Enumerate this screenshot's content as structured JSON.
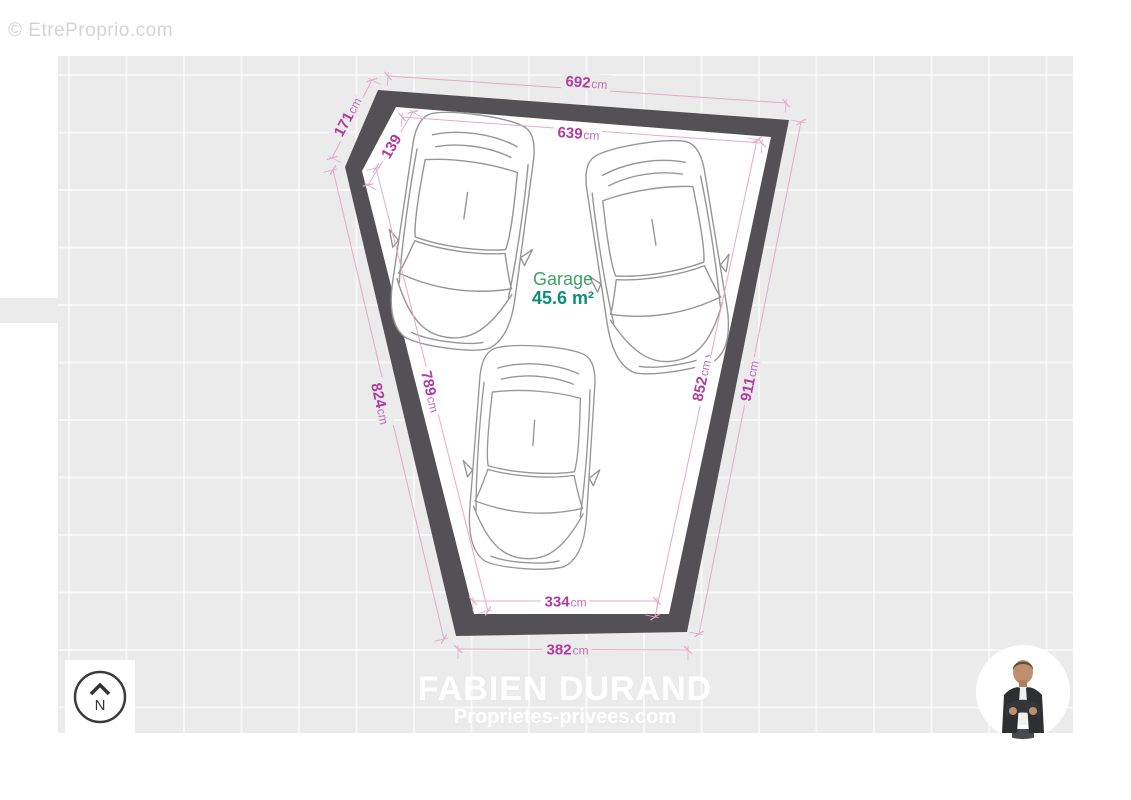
{
  "watermark": "© EtreProprio.com",
  "plan": {
    "room_label": "Garage",
    "room_area": "45.6 m²",
    "car_count": 3,
    "dimensions": [
      {
        "id": "top-outer",
        "value": "692",
        "unit": "cm"
      },
      {
        "id": "top-inner",
        "value": "639",
        "unit": "cm"
      },
      {
        "id": "corner-outer",
        "value": "171",
        "unit": "cm"
      },
      {
        "id": "corner-inner",
        "value": "139",
        "unit": ""
      },
      {
        "id": "left-outer",
        "value": "824",
        "unit": "cm"
      },
      {
        "id": "left-inner",
        "value": "789",
        "unit": "cm"
      },
      {
        "id": "right-inner",
        "value": "852",
        "unit": "cm"
      },
      {
        "id": "right-outer",
        "value": "911",
        "unit": "cm"
      },
      {
        "id": "bottom-inner",
        "value": "334",
        "unit": "cm"
      },
      {
        "id": "bottom-outer",
        "value": "382",
        "unit": "cm"
      }
    ]
  },
  "compass": {
    "label": "N"
  },
  "footer": {
    "agent_name": "FABIEN DURAND",
    "agency": "Proprietes-privees.com"
  },
  "colors": {
    "dimension_value": "#b3399f",
    "dimension_unit": "#c06fb8",
    "dimension_line": "#e2abc8",
    "wall": "#535156",
    "floor": "#ffffff",
    "room_label": "#3ca265",
    "room_area": "#0e8d7e",
    "canvas_bg": "#ebebeb",
    "footer_text": "#ffffff"
  }
}
